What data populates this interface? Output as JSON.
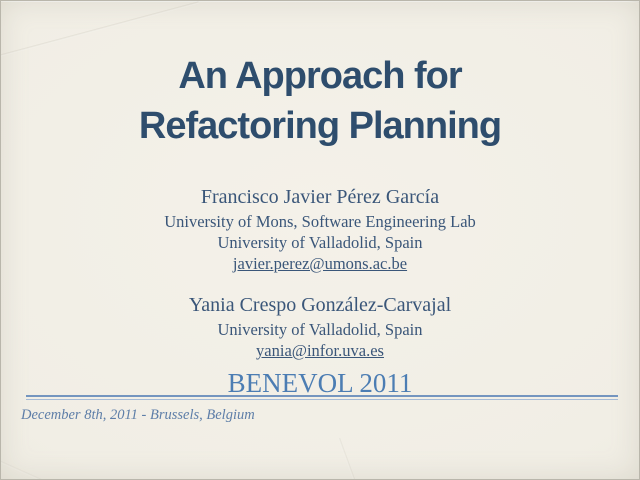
{
  "slide": {
    "title": {
      "line1": "An Approach for",
      "line2": "Refactoring Planning"
    },
    "author1": {
      "name": "Francisco Javier Pérez García",
      "affiliation1": "University of Mons, Software Engineering Lab",
      "affiliation2": "University of Valladolid, Spain",
      "email": "javier.perez@umons.ac.be"
    },
    "author2": {
      "name": "Yania Crespo González-Carvajal",
      "affiliation1": "University of Valladolid, Spain",
      "email": "yania@infor.uva.es"
    },
    "conference": "BENEVOL 2011",
    "footer": {
      "date_location": "December 8th, 2011 - Brussels, Belgium"
    },
    "colors": {
      "background": "#f1eee5",
      "title_text": "#2e4d6d",
      "body_text": "#3a5679",
      "conference_text": "#4c7db3",
      "footer_text": "#5e7ea8",
      "rule_dark": "#7495bf",
      "rule_light": "#a6bbd6"
    }
  }
}
